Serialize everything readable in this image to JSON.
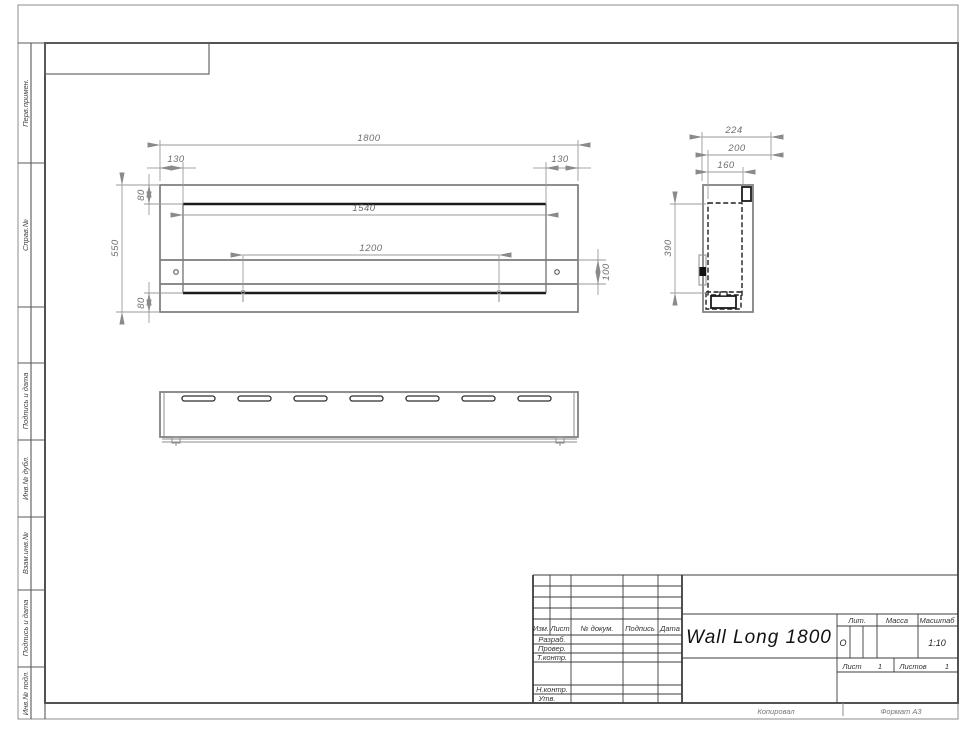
{
  "frame": {
    "left_labels": [
      "Перв.примен.",
      "Справ.№",
      "Подпись и дата",
      "Инв.№ дубл.",
      "Взам.инв.№",
      "Подпись и дата",
      "Инв.№ подл."
    ]
  },
  "views": {
    "front": {
      "dims": {
        "overall_width": "1800",
        "inset_left": "130",
        "inset_right": "130",
        "top_offset": "80",
        "overall_height": "550",
        "bottom_offset": "80",
        "opening_width": "1540",
        "slot_width": "1200",
        "bracket_height": "100"
      }
    },
    "side": {
      "dims": {
        "depth_total": "224",
        "depth_body": "200",
        "depth_inner": "160",
        "opening_height": "390"
      }
    }
  },
  "title_block": {
    "columns": {
      "izm": "Изм.",
      "list": "Лист",
      "doc": "№ докум.",
      "podpis": "Подпись",
      "data": "Дата"
    },
    "rows": {
      "razrab": "Разраб.",
      "prover": "Провер.",
      "tkontr": "Т.контр.",
      "nkontr": "Н.контр.",
      "utv": "Утв."
    },
    "title": "Wall Long 1800",
    "lit_label": "Лит.",
    "lit_value": "О",
    "mass_label": "Масса",
    "scale_label": "Масштаб",
    "scale_value": "1:10",
    "sheet_label": "Лист",
    "sheet_number": "1",
    "sheets_label": "Листов",
    "sheets_total": "1"
  },
  "footer": {
    "copy": "Копировал",
    "format": "Формат А3"
  }
}
